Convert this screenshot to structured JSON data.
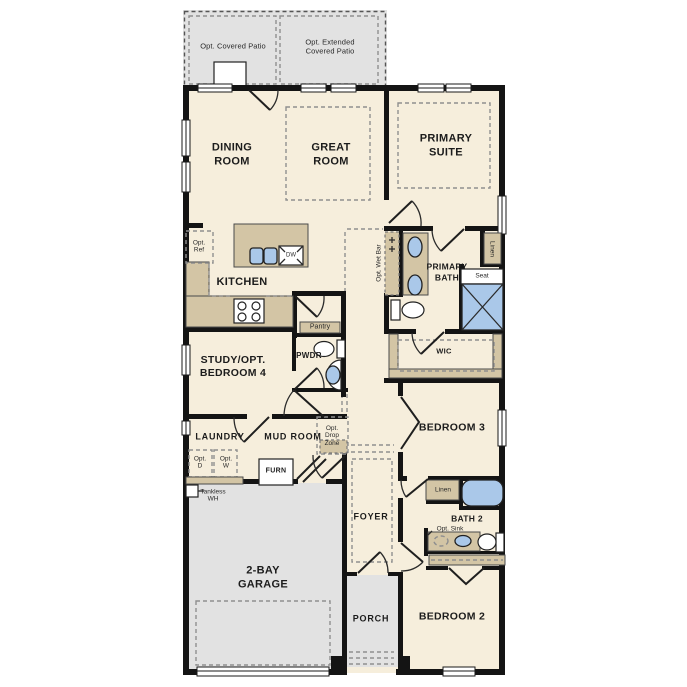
{
  "colors": {
    "floor": "#f6eedc",
    "concrete": "#e2e2e2",
    "cabinet": "#d3c5a5",
    "fixture": "#aac8e9",
    "wall": "#141414"
  },
  "labels": {
    "opt_covered_patio": "Opt. Covered Patio",
    "opt_extended_patio": "Opt. Extended\nCovered Patio",
    "dining": "DINING\nROOM",
    "great": "GREAT\nROOM",
    "primary_suite": "PRIMARY\nSUITE",
    "opt_ref": "Opt.\nRef",
    "kitchen": "KITCHEN",
    "dw": "DW",
    "opt_wet_bar": "Opt. Wet Bar",
    "primary_bath": "PRIMARY\nBATH",
    "linen_primary": "Linen",
    "seat": "Seat",
    "wic": "WIC",
    "pantry": "Pantry",
    "pwdr": "PWDR",
    "study": "STUDY/OPT.\nBEDROOM 4",
    "laundry": "LAUNDRY",
    "opt_d": "Opt.\nD",
    "opt_w": "Opt.\nW",
    "mud_room": "MUD ROOM",
    "opt_drop_zone": "Opt.\nDrop\nZone",
    "furn": "FURN",
    "tankless": "Tankless\nWH",
    "bedroom3": "BEDROOM 3",
    "linen_bath2": "Linen",
    "bath2": "BATH 2",
    "opt_sink": "Opt. Sink",
    "garage": "2-BAY\nGARAGE",
    "foyer": "FOYER",
    "porch": "PORCH",
    "bedroom2": "BEDROOM 2"
  }
}
